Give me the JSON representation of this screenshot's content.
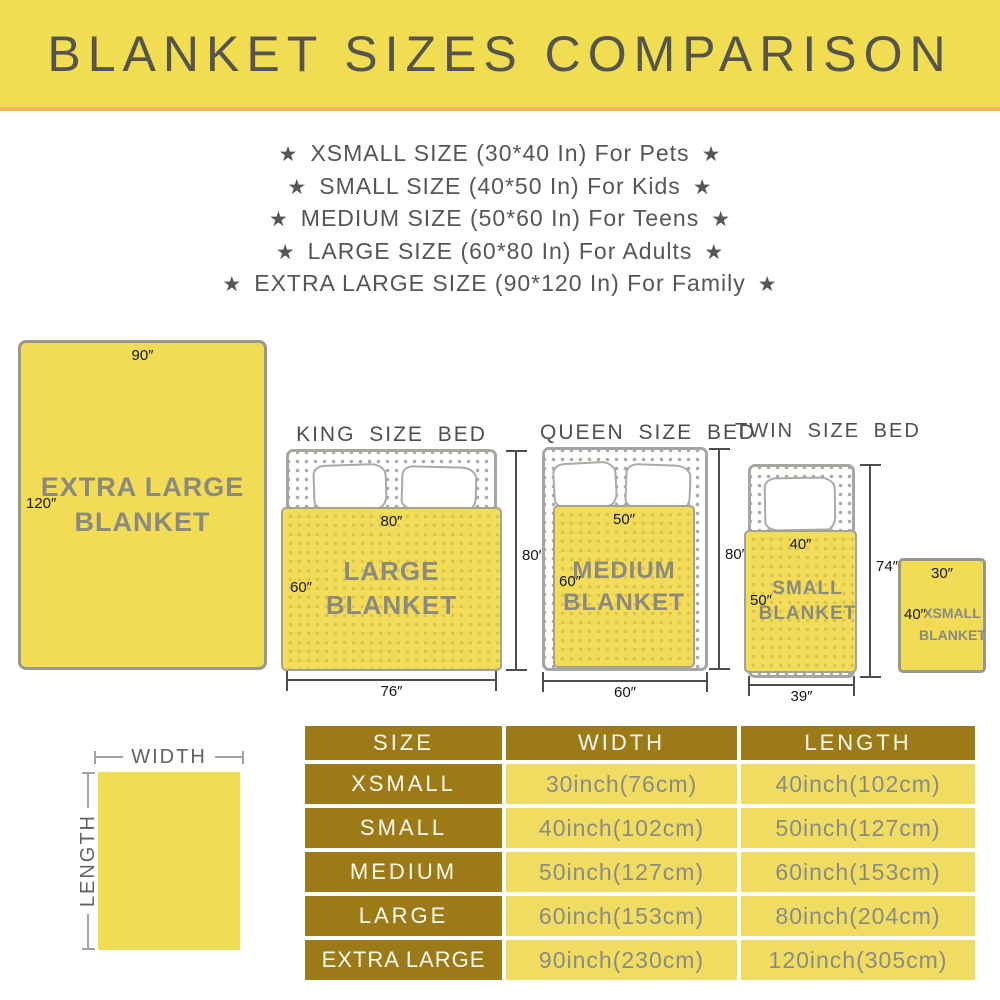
{
  "banner": {
    "title": "BLANKET SIZES COMPARISON"
  },
  "size_list": {
    "star": "★",
    "items": [
      "XSMALL SIZE (30*40 In) For Pets",
      "SMALL SIZE (40*50 In) For Kids",
      "MEDIUM SIZE (50*60 In) For Teens",
      "LARGE SIZE (60*80 In) For Adults",
      "EXTRA LARGE SIZE (90*120 In) For Family"
    ]
  },
  "diagrams": {
    "extra_large": {
      "top_dim": "90″",
      "side_dim": "120″",
      "label_line1": "EXTRA LARGE",
      "label_line2": "BLANKET"
    },
    "king": {
      "bed_title": "KING SIZE BED",
      "blanket_top_dim": "80″",
      "blanket_side_dim": "60″",
      "blanket_label": "LARGE BLANKET",
      "bed_length_dim": "80″",
      "bed_width_dim": "76″"
    },
    "queen": {
      "bed_title": "QUEEN SIZE BED",
      "blanket_top_dim": "50″",
      "blanket_side_dim": "60″",
      "label_line1": "MEDIUM",
      "label_line2": "BLANKET",
      "bed_length_dim": "80″",
      "bed_width_dim": "60″"
    },
    "twin": {
      "bed_title": "TWIN SIZE BED",
      "blanket_top_dim": "40″",
      "blanket_side_dim": "50″",
      "label_line1": "SMALL",
      "label_line2": "BLANKET",
      "bed_length_dim": "74″",
      "bed_width_dim": "39″"
    },
    "xsmall": {
      "top_dim": "30″",
      "side_dim": "40″",
      "label_line1": "XSMALL",
      "label_line2": "BLANKET"
    }
  },
  "legend": {
    "width": "WIDTH",
    "length": "LENGTH"
  },
  "table": {
    "headers": [
      "SIZE",
      "WIDTH",
      "LENGTH"
    ],
    "rows": [
      [
        "XSMALL",
        "30inch(76cm)",
        "40inch(102cm)"
      ],
      [
        "SMALL",
        "40inch(102cm)",
        "50inch(127cm)"
      ],
      [
        "MEDIUM",
        "50inch(127cm)",
        "60inch(153cm)"
      ],
      [
        "LARGE",
        "60inch(153cm)",
        "80inch(204cm)"
      ],
      [
        "EXTRA LARGE",
        "90inch(230cm)",
        "120inch(305cm)"
      ]
    ]
  },
  "colors": {
    "banner_yellow": "#F1DD52",
    "banner_underline": "#F2B45C",
    "blanket_yellow": "#F2DC55",
    "table_gold": "#9C7A18",
    "table_cell_yellow": "#F0DC60",
    "list_text_gray": "#55555A",
    "blanket_text_gray": "#8A8A80"
  }
}
